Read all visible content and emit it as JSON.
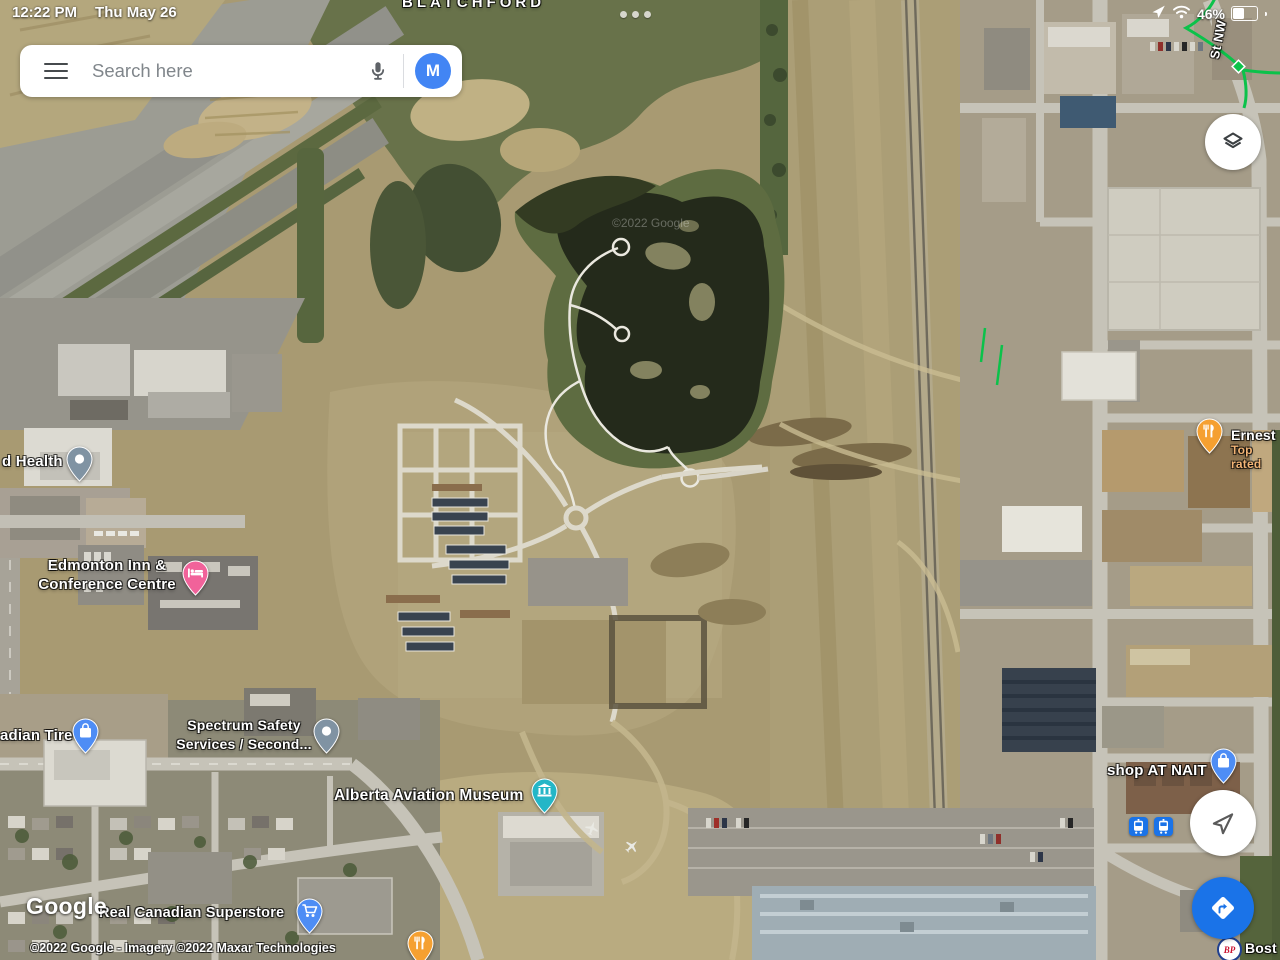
{
  "status_bar": {
    "time": "12:22 PM",
    "date": "Thu May 26",
    "battery_percent": "46%"
  },
  "search": {
    "placeholder": "Search here",
    "avatar_letter": "M"
  },
  "map": {
    "district_label": "BLATCHFORD",
    "street_label": "St NW",
    "watermark": "©2022 Google",
    "pois": {
      "health": {
        "label": "d Health"
      },
      "edmonton_inn": {
        "label": "Edmonton Inn &\nConference Centre"
      },
      "canadian_tire": {
        "label": "adian Tire"
      },
      "spectrum": {
        "label": "Spectrum Safety\nServices / Second..."
      },
      "aviation_museum": {
        "label": "Alberta Aviation Museum"
      },
      "ernest": {
        "label": "Ernest",
        "sublabel": "Top rated"
      },
      "shop_at_nait": {
        "label": "shop AT NAIT"
      },
      "superstore": {
        "label": "Real Canadian Superstore"
      },
      "boston_pizza": {
        "label": "Bost",
        "logo_text": "BP"
      }
    }
  },
  "attribution": {
    "logo": "Google",
    "copyright": "©2022 Google - Imagery ©2022 Maxar Technologies"
  },
  "colors": {
    "google_blue": "#4285F4",
    "directions_blue": "#1A73E8",
    "pin_pink": "#F1629A",
    "pin_orange": "#F5A031",
    "pin_teal": "#24B6C7",
    "pin_blue": "#4E8DF5",
    "pin_gray": "#8093A3",
    "trail_green": "#0BC24A"
  }
}
